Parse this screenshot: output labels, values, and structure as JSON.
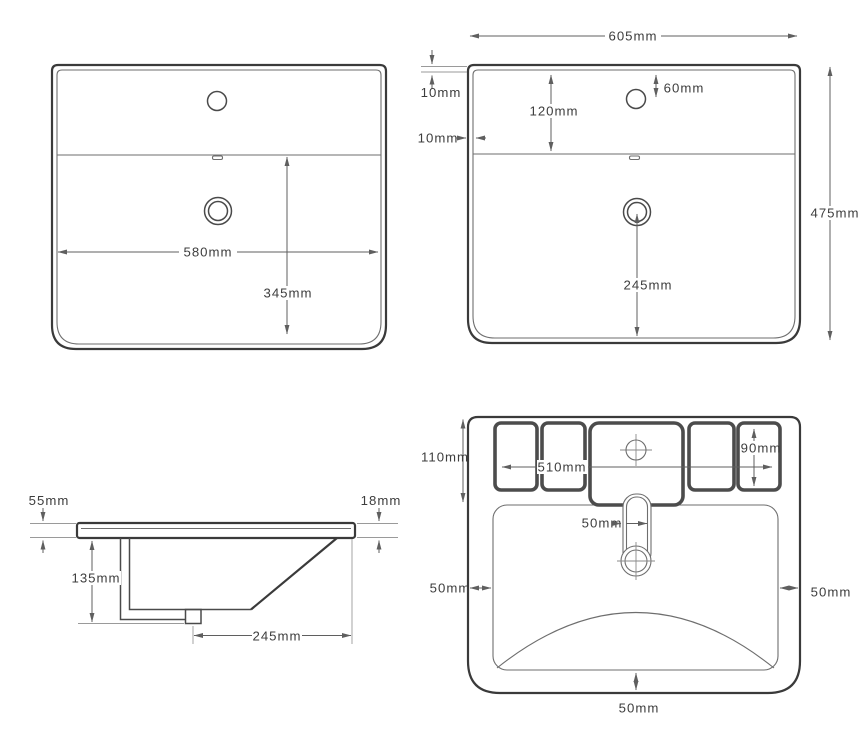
{
  "figure": {
    "type": "technical-drawing",
    "subject": "ceramic wash basin dimension diagram, four orthographic views",
    "unit": "mm"
  },
  "colors": {
    "outline": "#3a3a3a",
    "line": "#6e6e6e",
    "dim": "#5f5f5f",
    "ext": "#9a9a9a",
    "thick": "#4c4c4c",
    "text": "#3d3d3d",
    "bg": "#ffffff"
  },
  "views": {
    "plan_left": {
      "name": "top view A",
      "dims": {
        "overall_width": "580mm",
        "drain_center_from_divider": "345mm"
      }
    },
    "plan_right": {
      "name": "top view B",
      "dims": {
        "overall_width": "605mm",
        "overall_depth": "475mm",
        "rim_gap_top": "10mm",
        "rim_gap_side": "10mm",
        "back_ledge_depth": "120mm",
        "faucet_center_from_back": "60mm",
        "drain_center_to_front": "245mm"
      }
    },
    "side": {
      "name": "side section",
      "dims": {
        "back_edge_height": "55mm",
        "front_edge_height": "18mm",
        "bowl_depth": "135mm",
        "drain_center_to_front_edge": "245mm"
      }
    },
    "bottom": {
      "name": "bottom view",
      "dims": {
        "mounting_zone_depth": "110mm",
        "mounting_zone_width": "510mm",
        "mounting_block_height": "90mm",
        "drain_pipe_width": "50mm",
        "side_clearance_left": "50mm",
        "side_clearance_right": "50mm",
        "front_clearance": "50mm"
      }
    }
  }
}
